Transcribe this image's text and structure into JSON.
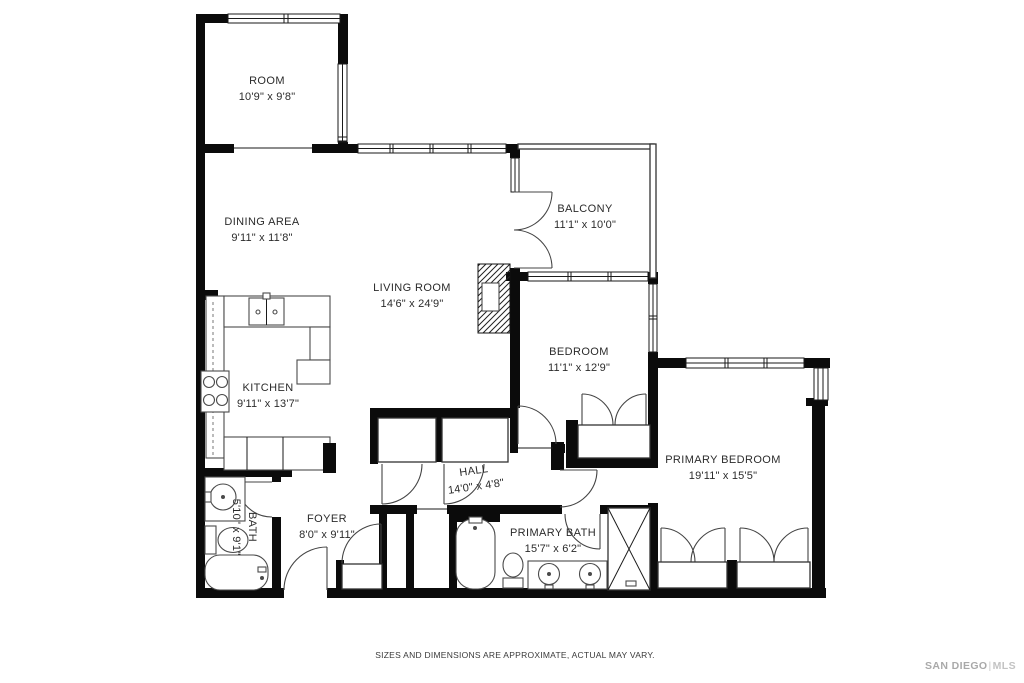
{
  "colors": {
    "wall": "#0b0b0b",
    "fixture_line": "#4a4a4a",
    "label_text": "#2b2b2b",
    "logo_gray": "#b3b3b3",
    "background": "#ffffff"
  },
  "rooms": {
    "room": {
      "name": "ROOM",
      "dims": "10'9\" x 9'8\""
    },
    "dining": {
      "name": "DINING AREA",
      "dims": "9'11\" x 11'8\""
    },
    "balcony": {
      "name": "BALCONY",
      "dims": "11'1\" x 10'0\""
    },
    "living": {
      "name": "LIVING ROOM",
      "dims": "14'6\" x 24'9\""
    },
    "bedroom": {
      "name": "BEDROOM",
      "dims": "11'1\" x 12'9\""
    },
    "kitchen": {
      "name": "KITCHEN",
      "dims": "9'11\" x 13'7\""
    },
    "primary_bedroom": {
      "name": "PRIMARY BEDROOM",
      "dims": "19'11\" x 15'5\""
    },
    "hall": {
      "name": "HALL",
      "dims": "14'0\" x 4'8\""
    },
    "foyer": {
      "name": "FOYER",
      "dims": "8'0\" x 9'11\""
    },
    "bath": {
      "name": "BATH",
      "dims": "5'10\" x 9'1\""
    },
    "primary_bath": {
      "name": "PRIMARY BATH",
      "dims": "15'7\" x 6'2\""
    }
  },
  "footer": {
    "disclaimer": "SIZES AND DIMENSIONS ARE APPROXIMATE, ACTUAL MAY VARY."
  },
  "brand": {
    "name": "SAN DIEGO",
    "divider": "|",
    "suffix": "MLS"
  }
}
